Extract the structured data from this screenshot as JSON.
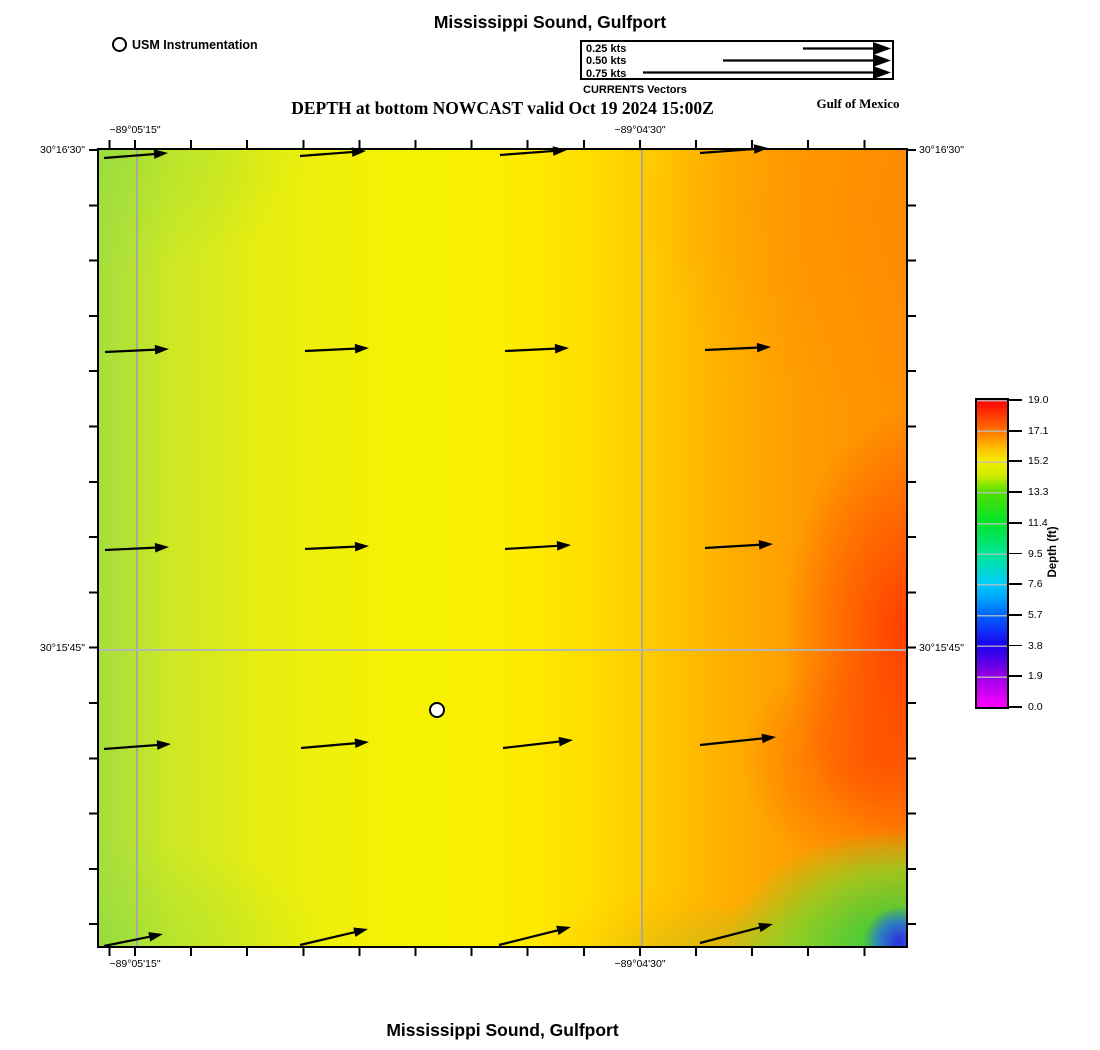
{
  "page": {
    "title_top": "Mississippi Sound, Gulfport",
    "title_bottom": "Mississippi Sound, Gulfport",
    "subtitle": "DEPTH at bottom NOWCAST valid Oct 19 2024 15:00Z",
    "region_label": "Gulf of Mexico"
  },
  "instrument_legend": {
    "label": "USM Instrumentation"
  },
  "currents_legend": {
    "title": "CURRENTS Vectors",
    "entries": [
      {
        "label": "0.25 kts"
      },
      {
        "label": "0.50 kts"
      },
      {
        "label": "0.75 kts"
      }
    ],
    "vectors": [
      [
        803,
        48.5,
        891,
        48.5
      ],
      [
        723,
        60.5,
        891,
        60.5
      ],
      [
        643,
        72.5,
        891,
        72.5
      ]
    ]
  },
  "axes": {
    "top": [
      {
        "text": "−89°05'15\""
      },
      {
        "text": "−89°04'30\""
      }
    ],
    "bottom": [
      {
        "text": "−89°05'15\""
      },
      {
        "text": "−89°04'30\""
      }
    ],
    "left": [
      {
        "text": "30°16'30\""
      },
      {
        "text": "30°15'45\""
      }
    ],
    "right": [
      {
        "text": "30°16'30\""
      },
      {
        "text": "30°15'45\""
      }
    ]
  },
  "colorbar": {
    "title": "Depth (ft)",
    "ticks": [
      "19.0",
      "17.1",
      "15.2",
      "13.3",
      "11.4",
      "9.5",
      "7.6",
      "5.7",
      "3.8",
      "1.9",
      "0.0"
    ],
    "colors_top_to_bottom": [
      "#fd0000",
      "#ff7200",
      "#f4ef00",
      "#52e000",
      "#00e42a",
      "#00e795",
      "#00cdfa",
      "#0064ff",
      "#1b00f0",
      "#9b00e8",
      "#fb00ff"
    ]
  },
  "map": {
    "instrument_marker": {
      "x": 437,
      "y": 710
    },
    "gridlines": {
      "vertical_x": [
        135,
        640
      ],
      "horizontal_y": [
        648
      ]
    },
    "vectors": [
      [
        104,
        158,
        168,
        153
      ],
      [
        300,
        156,
        366,
        151
      ],
      [
        500,
        155,
        567,
        150
      ],
      [
        700,
        153,
        768,
        148
      ],
      [
        105,
        352,
        169,
        349
      ],
      [
        305,
        351,
        369,
        348
      ],
      [
        505,
        351,
        569,
        348
      ],
      [
        705,
        350,
        771,
        347
      ],
      [
        105,
        550,
        169,
        547
      ],
      [
        305,
        549,
        369,
        546
      ],
      [
        505,
        549,
        571,
        545
      ],
      [
        705,
        548,
        773,
        544
      ],
      [
        104,
        749,
        171,
        744
      ],
      [
        301,
        748,
        369,
        742
      ],
      [
        503,
        748,
        573,
        740
      ],
      [
        700,
        745,
        776,
        737
      ],
      [
        104,
        946,
        163,
        934
      ],
      [
        300,
        945,
        368,
        929
      ],
      [
        499,
        945,
        571,
        927
      ],
      [
        700,
        943,
        773,
        924
      ]
    ]
  },
  "chart_data": {
    "type": "heatmap",
    "title": "DEPTH at bottom NOWCAST valid Oct 19 2024 15:00Z",
    "units": "ft",
    "value_range": [
      0.0,
      19.0
    ],
    "colorbar_ticks": [
      19.0,
      17.1,
      15.2,
      13.3,
      11.4,
      9.5,
      7.6,
      5.7,
      3.8,
      1.9,
      0.0
    ],
    "x_axis_labels": [
      "−89°05'15\"",
      "−89°04'30\""
    ],
    "y_axis_labels": [
      "30°16'30\"",
      "30°15'45\""
    ],
    "approx_depth_grid_ft": {
      "note": "coarse visual estimate, rows N to S, cols W to E",
      "rows": [
        [
          14.5,
          15.2,
          15.6,
          16.4,
          17.4
        ],
        [
          14.8,
          15.3,
          15.9,
          17.0,
          18.2
        ],
        [
          14.8,
          15.4,
          16.0,
          17.6,
          18.8
        ],
        [
          14.6,
          15.2,
          16.0,
          17.4,
          18.6
        ],
        [
          13.8,
          15.0,
          15.8,
          15.5,
          6.0
        ]
      ]
    },
    "current_vectors": {
      "direction": "eastward",
      "legend_speeds_kts": [
        0.25,
        0.5,
        0.75
      ]
    }
  }
}
